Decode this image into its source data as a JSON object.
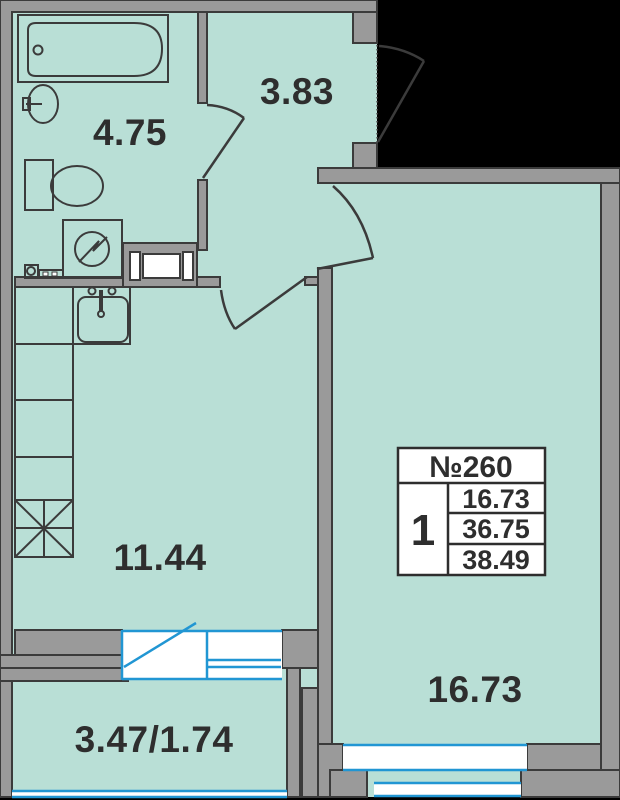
{
  "plan_title": "apartment floor plan",
  "rooms": {
    "bathroom": {
      "area": "4.75"
    },
    "hallway": {
      "area": "3.83"
    },
    "kitchen_living": {
      "area": "11.44"
    },
    "bedroom": {
      "area": "16.73"
    },
    "balcony": {
      "area": "3.47/1.74"
    }
  },
  "info_box": {
    "apartment_number": "№260",
    "room_count": "1",
    "living_area": "16.73",
    "apartment_area": "36.75",
    "total_area": "38.49"
  },
  "colors": {
    "floor": "#b9dfd6",
    "wall": "#9a9a9a",
    "outline": "#3b3b3b",
    "window_blue": "#2196d3",
    "outside_black": "#000000",
    "text": "#2e2e2e"
  }
}
